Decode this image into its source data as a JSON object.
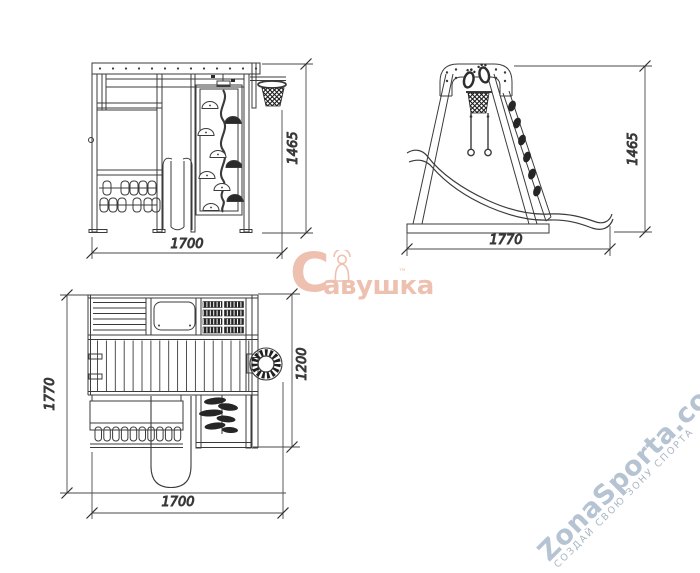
{
  "title": "Playground complex technical drawing, three orthographic views",
  "colors": {
    "line": "#3b3b3b",
    "hold": "#262626",
    "brand": "#eec0af",
    "site": "#b6c3d2",
    "site2": "#a9b6c4"
  },
  "views": {
    "front": {
      "width_dim": "1700",
      "height_dim": "1465"
    },
    "side": {
      "width_dim": "1770",
      "height_dim": "1465"
    },
    "top": {
      "width_dim": "1700",
      "depth_dim": "1770",
      "side_dim": "1200"
    }
  },
  "watermarks": {
    "brand": {
      "initial": "С",
      "rest": "авушка",
      "tm": "™"
    },
    "site": {
      "name": "ZonaSporta.com",
      "tagline": "СОЗДАЙ СВОЮ ЗОНУ СПОРТА"
    }
  }
}
